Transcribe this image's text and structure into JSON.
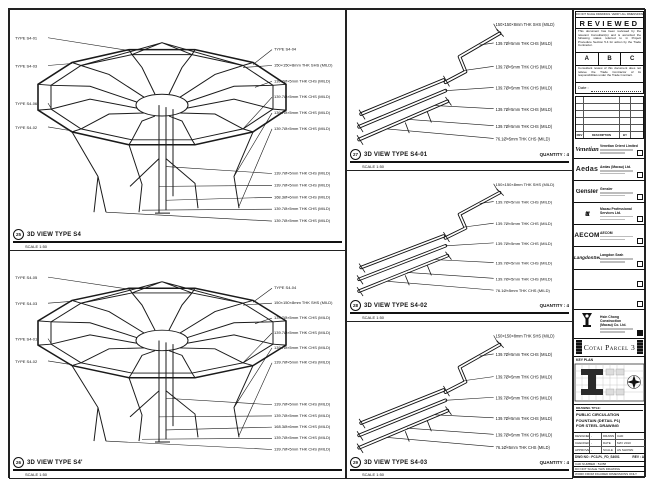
{
  "views": {
    "v25": {
      "num": "25",
      "title": "3D VIEW TYPE S4",
      "scale": "SCALE 1:50",
      "left": [
        "TYPE S4-01",
        "TYPE S4-03",
        "TYPE S4-06",
        "TYPE S4-02"
      ],
      "right": [
        "TYPE S4-04",
        "150×150×8mm THK SHS (MILD)",
        "139.7Ø×5mm THK CHS (MILD)",
        "139.7Ø×5mm THK CHS (MILD)",
        "139.7Ø×5mm THK CHS (MILD)",
        "139.7Ø×5mm THK CHS (MILD)"
      ],
      "bottom": [
        "139.7Ø×5mm THK CHS (MILD)",
        "139.7Ø×5mm THK CHS (MILD)",
        "168.3Ø×6mm THK CHS (MILD)",
        "139.7Ø×5mm THK CHS (MILD)",
        "139.7Ø×5mm THK CHS (MILD)"
      ]
    },
    "v26": {
      "num": "26",
      "title": "3D VIEW TYPE S4'",
      "scale": "SCALE 1:50",
      "left": [
        "TYPE S4-05",
        "TYPE S4-03",
        "TYPE S4-01",
        "TYPE S4-02"
      ],
      "right": [
        "TYPE S4-04",
        "150×150×8mm THK SHS (MILD)",
        "139.7Ø×5mm THK CHS (MILD)",
        "139.7Ø×5mm THK CHS (MILD)",
        "139.7Ø×5mm THK CHS (MILD)",
        "139.7Ø×5mm THK CHS (MILD)"
      ],
      "bottom": [
        "139.7Ø×5mm THK CHS (MILD)",
        "139.7Ø×5mm THK CHS (MILD)",
        "168.3Ø×6mm THK CHS (MILD)",
        "139.7Ø×5mm THK CHS (MILD)",
        "139.7Ø×5mm THK CHS (MILD)"
      ]
    },
    "v27": {
      "num": "27",
      "title": "3D VIEW TYPE S4-01",
      "scale": "SCALE 1:50",
      "qty": "QUANTITY : 4",
      "ann": [
        "150×150×8mm THK SHS (MILD)",
        "139.7Ø×5mm THK CHS (MILD)",
        "139.7Ø×5mm THK CHS (MILD)",
        "139.7Ø×5mm THK CHS (MILD)",
        "139.7Ø×5mm THK CHS (MILD)",
        "139.7Ø×5mm THK CHS (MILD)",
        "76.1Ø×5mm THK CHS (MILD)"
      ]
    },
    "v28": {
      "num": "28",
      "title": "3D VIEW TYPE S4-02",
      "scale": "SCALE 1:50",
      "qty": "QUANTITY : 4",
      "ann": [
        "150×150×8mm THK SHS (MILD)",
        "139.7Ø×5mm THK CHS (MILD)",
        "139.7Ø×5mm THK CHS (MILD)",
        "139.7Ø×5mm THK CHS (MILD)",
        "139.7Ø×5mm THK CHS (MILD)",
        "139.7Ø×5mm THK CHS (MILD)",
        "76.1Ø×5mm THK CHS (MILD)"
      ]
    },
    "v29": {
      "num": "29",
      "title": "3D VIEW TYPE S4-03",
      "scale": "SCALE 1:50",
      "qty": "QUANTITY : 4",
      "ann": [
        "150×150×8mm THK SHS (MILD)",
        "139.7Ø×5mm THK CHS (MILD)",
        "139.7Ø×5mm THK CHS (MILD)",
        "139.7Ø×5mm THK CHS (MILD)",
        "139.7Ø×5mm THK CHS (MILD)",
        "139.7Ø×5mm THK CHS (MILD)",
        "76.1Ø×5mm THK CHS (MILD)"
      ]
    }
  },
  "tb": {
    "micronote": "DO NOT SCALE DRAWINGS. VERIFY ALL DIMENSIONS ON SITE.",
    "reviewed": "REVIEWED",
    "para1": "This document has been reviewed by the relevant Consultant(s) and is accorded the following status referred to in Project Procedure Section 5.4 for action by the Trade Contractor.",
    "opt_a": "A",
    "opt_b": "B",
    "opt_c": "C",
    "para2": "Consultant review of this document does not relieve the Trade Contractor of its responsibilities under the Trade Contract.",
    "date_label": "Date :",
    "rev_head": {
      "rev": "REV",
      "desc": "DESCRIPTION",
      "by": "BY"
    },
    "firms": [
      {
        "logo": "Venetian",
        "name": "Venetian Orient Limited"
      },
      {
        "logo": "Aedas",
        "name": "Aedas (Macau) Ltd."
      },
      {
        "logo": "Gensler",
        "name": "Gensler"
      },
      {
        "logo": "ttt",
        "name": "Macau Professional Services Ltd."
      },
      {
        "logo": "AECOM",
        "name": "AECOM"
      },
      {
        "logo": "LangdonSeah",
        "name": "Langdon Seah"
      }
    ],
    "contractor": {
      "name1": "Hsin Chong Construction",
      "name2": "(Macau) Co. Ltd."
    },
    "project": "Cotai Parcel 3",
    "keyplan_label": "KEY PLAN",
    "dt_label": "DRAWING TITLE:",
    "dt1": "PUBLIC CIRCULATION",
    "dt2": "FOUNTAIN (DETAIL P1)",
    "dt3": "FOR STEEL DRAWING",
    "f": {
      "designed": "DESIGNED",
      "checked": "CHECKED",
      "approved": "APPROVED",
      "v_designed": "-",
      "v_checked": "-",
      "v_approved": "-",
      "drawn": "DRAWN",
      "v_drawn": "CAD",
      "date": "DATE",
      "v_date": "MAY 2010",
      "scale": "SCALE",
      "v_scale": "AS SHOWN",
      "dwg_label": "DWG NO :",
      "dwg_no": "PC3-PL_FD_S4001",
      "rev": "REV : A",
      "cad_label": "CAD NUMBER :",
      "cad_no": "51358",
      "noteA": "DO NOT SCALE THIS DRAWING",
      "noteB": "WORK FROM FIGURED DIMENSIONS ONLY"
    }
  }
}
